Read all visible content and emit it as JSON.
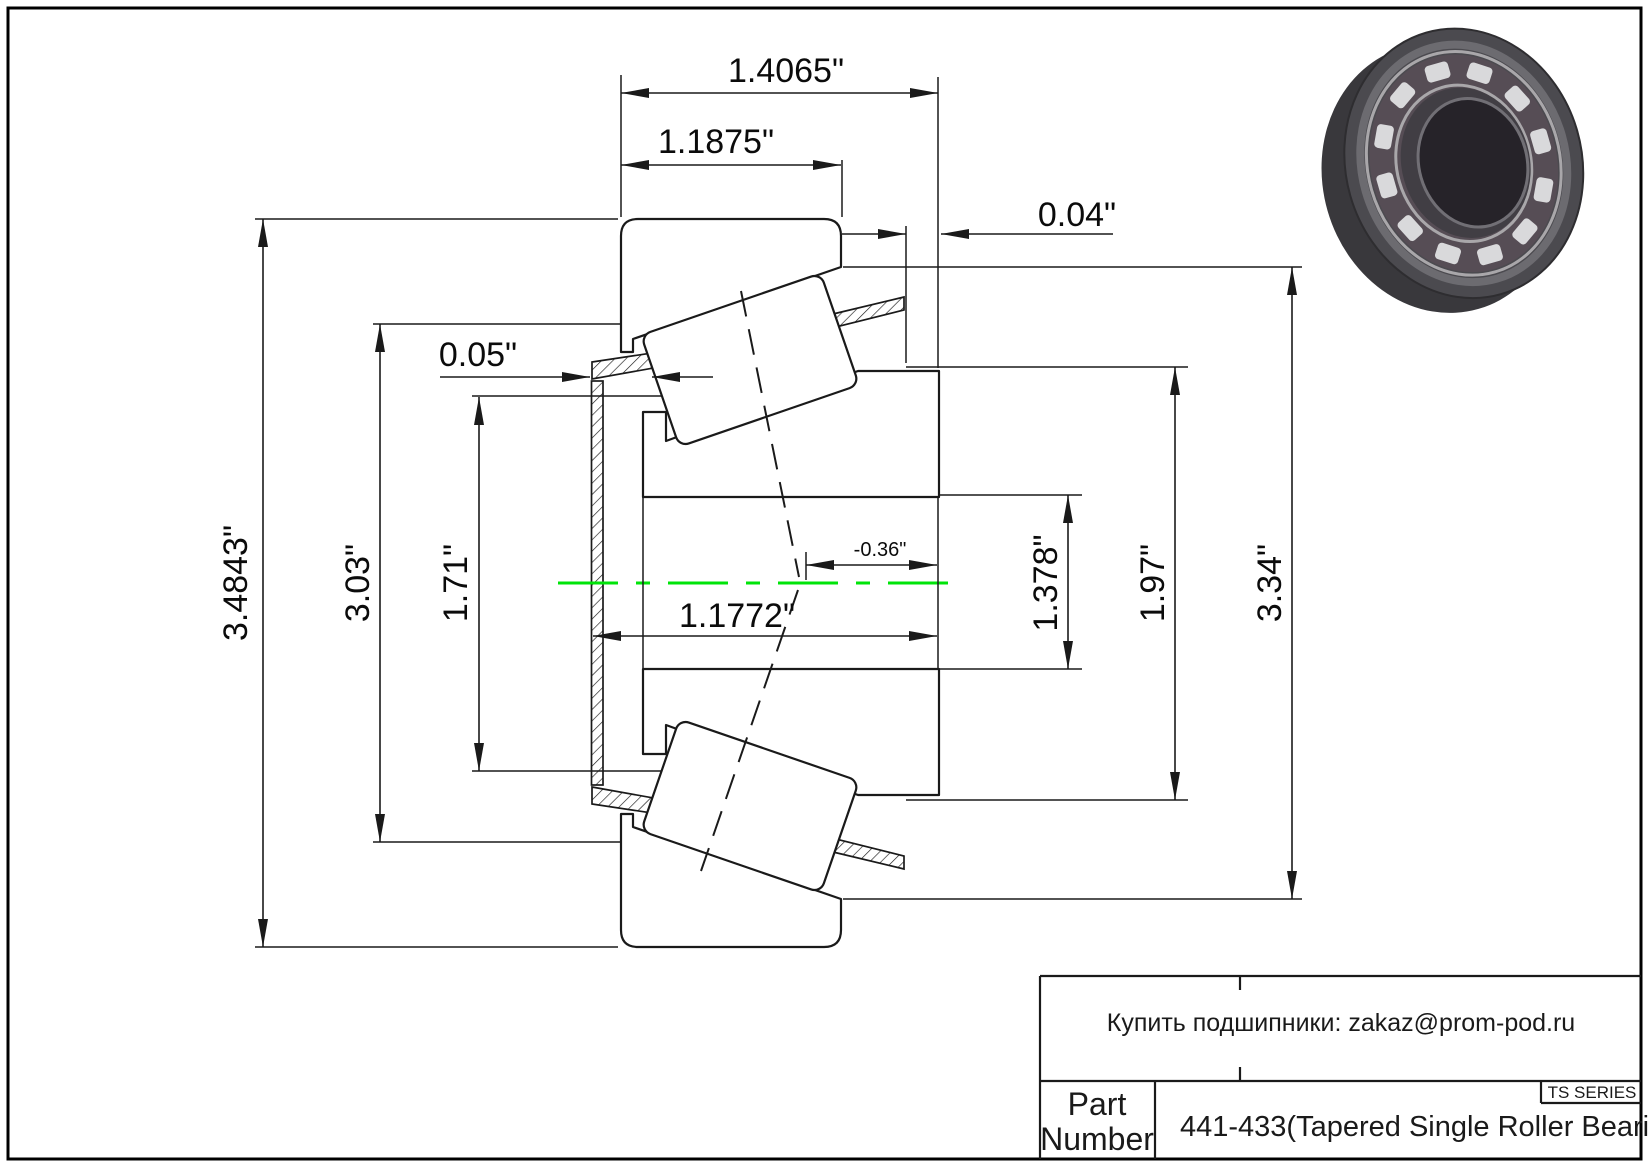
{
  "page": {
    "background": "#ffffff",
    "line_color": "#1a1a1a"
  },
  "drawing": {
    "centerline_color": "#00e409",
    "dims": {
      "overall_width": "1.4065\"",
      "cup_width": "1.1875\"",
      "right_offset": "0.04\"",
      "cage_protrusion": "0.05\"",
      "outer_dia_1": "3.4843\"",
      "outer_dia_2": "3.03\"",
      "inner_step_dia": "1.71\"",
      "cone_width": "1.1772\"",
      "center_offset": "-0.36\"",
      "bore_dia": "1.378\"",
      "rib_dia": "1.97\"",
      "cup_od": "3.34\""
    }
  },
  "photo": {
    "label": "tapered-roller-bearing-3d-render",
    "side_wall": "#39383c",
    "front_ring": "#4b4a4f",
    "chamfer": "#6c6b70",
    "cage_band": "#564d55",
    "rail": "#a9a7aa",
    "roller": "#d9d9db",
    "inner_face": "#413e44",
    "bore": "#262329",
    "bore_rim": "#716f75"
  },
  "title_block": {
    "note": "Купить подшипники: zakaz@prom-pod.ru",
    "series": "TS SERIES",
    "part_label_line1": "Part",
    "part_label_line2": "Number",
    "part_description": "441-433(Tapered Single Roller Bearings)"
  }
}
